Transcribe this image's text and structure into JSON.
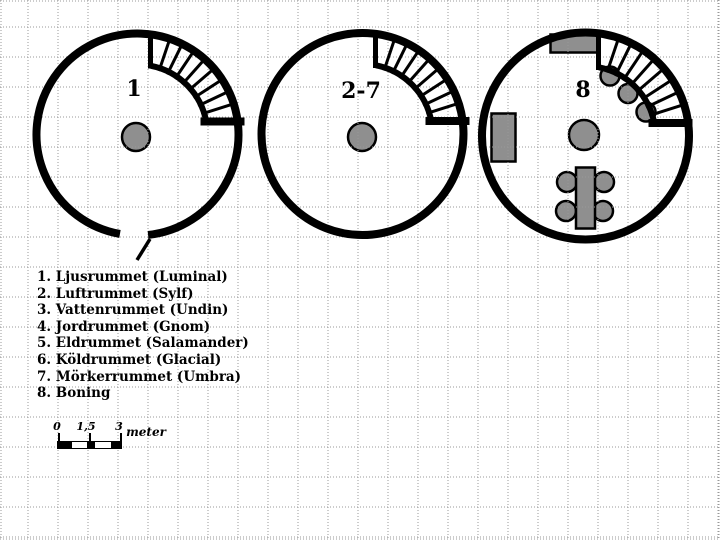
{
  "towers": [
    {
      "label": "1"
    },
    {
      "label": "2-7"
    },
    {
      "label": "8"
    }
  ],
  "legend": {
    "items": [
      "1. Ljusrummet (Luminal)",
      "2. Luftrummet (Sylf)",
      "3. Vattenrummet (Undin)",
      "4. Jordrummet (Gnom)",
      "5. Eldrummet (Salamander)",
      "6. Köldrummet (Glacial)",
      "7. Mörkerrummet (Umbra)",
      "8. Boning"
    ]
  },
  "scale_bar": {
    "tick_labels": [
      "0",
      "1,5",
      "3"
    ],
    "unit": "meter"
  },
  "colors": {
    "wall": "#000000",
    "furniture_fill": "#8f8f8f",
    "grid_dots": "#999999",
    "background": "#ffffff"
  }
}
